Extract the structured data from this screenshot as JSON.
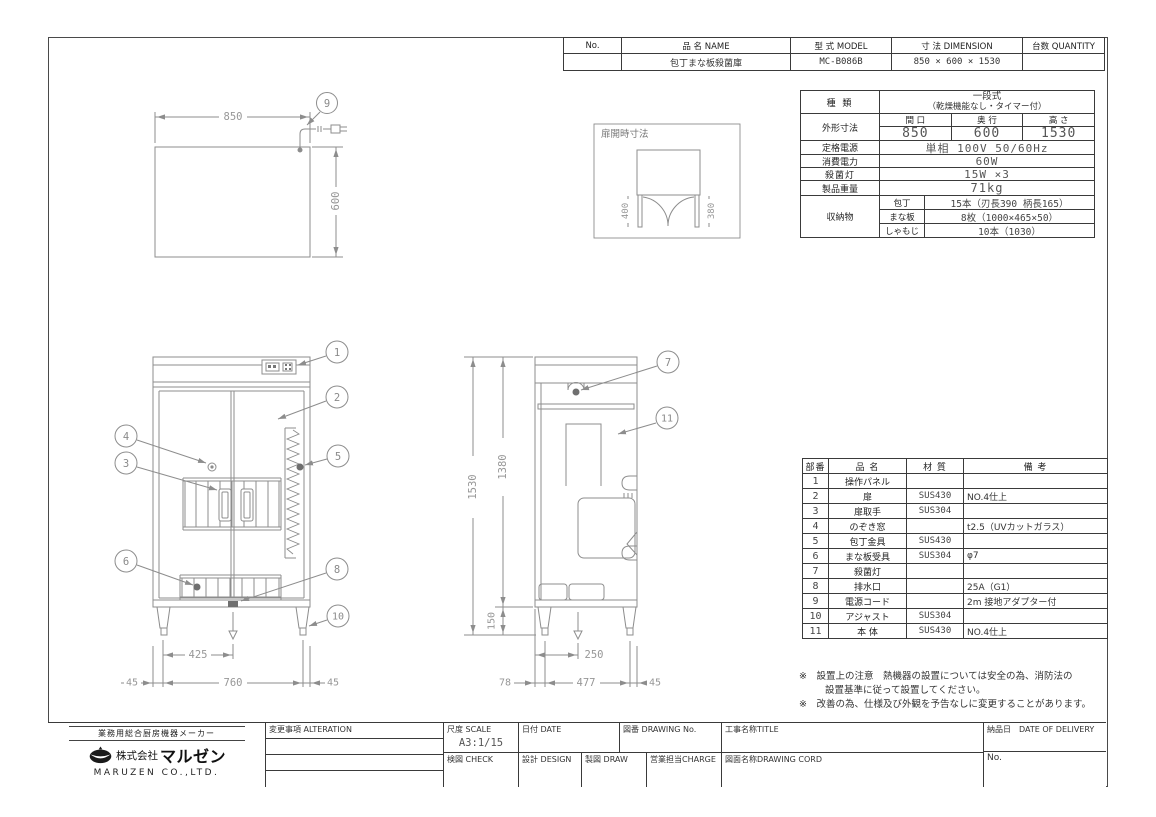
{
  "header_table": {
    "no_label": "No.",
    "name_label": "品 名 NAME",
    "model_label": "型 式 MODEL",
    "dimension_label": "寸 法 DIMENSION",
    "quantity_label": "台数 QUANTITY",
    "no_value": "",
    "name_value": "包丁まな板殺菌庫",
    "model_value": "MC-B086B",
    "dimension_value": "850 × 600 × 1530",
    "quantity_value": ""
  },
  "spec_table": {
    "type_label": "種  類",
    "type_value_line1": "一段式",
    "type_value_line2": "（乾燥機能なし・タイマー付）",
    "outer_label": "外形寸法",
    "width_label": "間 口",
    "depth_label": "奥 行",
    "height_label": "高 さ",
    "width_value": "850",
    "depth_value": "600",
    "height_value": "1530",
    "power_label": "定格電源",
    "power_value": "単相 100V 50/60Hz",
    "wattage_label": "消費電力",
    "wattage_value": "60W",
    "lamp_label": "殺菌灯",
    "lamp_value": "15W ×3",
    "weight_label": "製品重量",
    "weight_value": "71kg",
    "storage_label": "収納物",
    "storage_rows": [
      {
        "item": "包丁",
        "value": "15本（刃長390 柄長165）"
      },
      {
        "item": "まな板",
        "value": "8枚（1000×465×50）"
      },
      {
        "item": "しゃもじ",
        "value": "10本（1030）"
      }
    ]
  },
  "parts_table": {
    "no_label": "部番",
    "name_label": "品  名",
    "material_label": "材 質",
    "note_label": "備  考",
    "rows": [
      {
        "no": "1",
        "name": "操作パネル",
        "material": "",
        "note": ""
      },
      {
        "no": "2",
        "name": "扉",
        "material": "SUS430",
        "note": "NO.4仕上"
      },
      {
        "no": "3",
        "name": "扉取手",
        "material": "SUS304",
        "note": ""
      },
      {
        "no": "4",
        "name": "のぞき窓",
        "material": "",
        "note": "t2.5（UVカットガラス）"
      },
      {
        "no": "5",
        "name": "包丁金具",
        "material": "SUS430",
        "note": ""
      },
      {
        "no": "6",
        "name": "まな板受具",
        "material": "SUS304",
        "note": "φ7"
      },
      {
        "no": "7",
        "name": "殺菌灯",
        "material": "",
        "note": ""
      },
      {
        "no": "8",
        "name": "排水口",
        "material": "",
        "note": "25A（G1）"
      },
      {
        "no": "9",
        "name": "電源コード",
        "material": "",
        "note": "2m 接地アダプター付"
      },
      {
        "no": "10",
        "name": "アジャスト",
        "material": "SUS304",
        "note": ""
      },
      {
        "no": "11",
        "name": "本 体",
        "material": "SUS430",
        "note": "NO.4仕上"
      }
    ]
  },
  "notes": {
    "line1": "※　設置上の注意　熱機器の設置については安全の為、消防法の",
    "line2": "設置基準に従って設置してください。",
    "line3": "※　改善の為、仕様及び外観を予告なしに変更することがあります。"
  },
  "title_block": {
    "maker_tagline": "業務用総合厨房機器メーカー",
    "company_prefix": "株式会社",
    "company_name": "マルゼン",
    "company_en": "MARUZEN CO.,LTD.",
    "alteration_label": "変更事項 ALTERATION",
    "scale_label": "尺度 SCALE",
    "scale_value": "A3:1/15",
    "date_label": "日付 DATE",
    "drawing_no_label": "図番 DRAWING No.",
    "title_label": "工事名称TITLE",
    "check_label": "検図 CHECK",
    "design_label": "設計 DESIGN",
    "draw_label": "製図 DRAW",
    "charge_label": "営業担当CHARGE",
    "drawing_cord_label": "図面名称DRAWING CORD",
    "delivery_label": "納品日　DATE OF DELIVERY",
    "delivery_no_label": "No."
  },
  "drawing": {
    "top_view": {
      "dim_width": "850",
      "dim_depth": "600",
      "callout": "9"
    },
    "door_detail": {
      "title": "扉開時寸法",
      "dim_left": "400",
      "dim_right": "380"
    },
    "front_view": {
      "c1": "1",
      "c2": "2",
      "c3": "3",
      "c4": "4",
      "c5": "5",
      "c6": "6",
      "c8": "8",
      "c10": "10",
      "dim_center": "425",
      "dim_span": "760",
      "dim_left": "45",
      "dim_right": "45"
    },
    "side_view": {
      "c7": "7",
      "c11": "11",
      "dim_total": "1530",
      "dim_body": "1380",
      "dim_leg": "150",
      "dim_drain": "250",
      "dim_front": "78",
      "dim_span": "477",
      "dim_rear": "45"
    }
  }
}
